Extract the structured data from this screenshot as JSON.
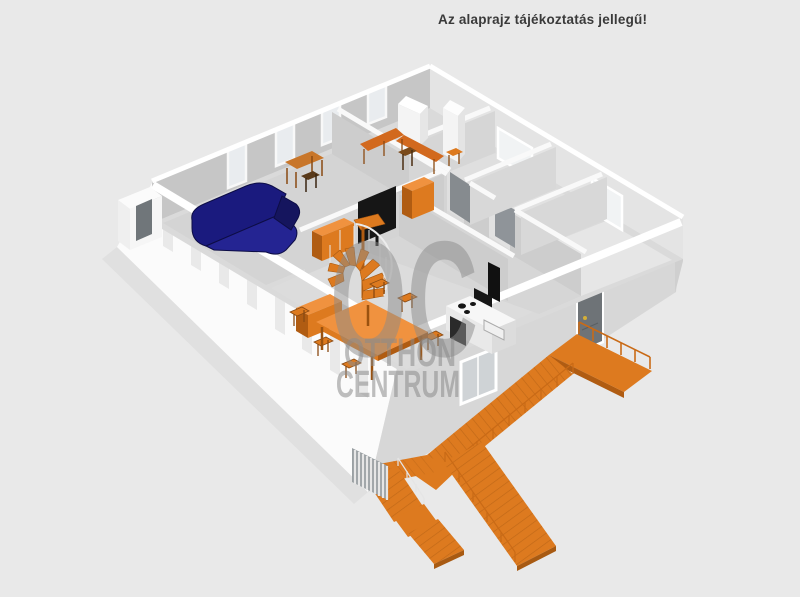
{
  "header": {
    "disclaimer": "Az alaprajz tájékoztatás jellegű!"
  },
  "watermark": {
    "monogram": "OC",
    "line1": "OTTHON",
    "line2": "CENTRUM"
  },
  "scene": {
    "background": "#e9e9e9",
    "colors": {
      "text_dark": "#3a3a3a",
      "facade_light": "#fbfbfb",
      "facade_shadow": "#d7d7d7",
      "wall_interior_dark": "#c6c6c6",
      "wall_interior_light": "#e4e4e4",
      "partition_face": "#cdcdcd",
      "floor": "#dadada",
      "accent_orange": "#dd7a1f",
      "accent_orange_dark": "#b05c12",
      "accent_orange_light": "#f0923f",
      "sofa_navy": "#1a1a7e",
      "tv_black": "#161616",
      "interior_door_gray": "#868b8f",
      "entrance_door_gray": "#6e7377",
      "watermark_gray": "#8a8a8a"
    },
    "objects": [
      "corner-sofa",
      "writing-desk",
      "office-desk",
      "wardrobe",
      "tv-wall-unit",
      "spiral-staircase",
      "dining-table",
      "dining-chairs",
      "sideboard",
      "kitchen-counter",
      "extractor-hood",
      "entrance-door",
      "exterior-staircase",
      "entrance-platform",
      "balcony-railing",
      "west-porch"
    ]
  }
}
